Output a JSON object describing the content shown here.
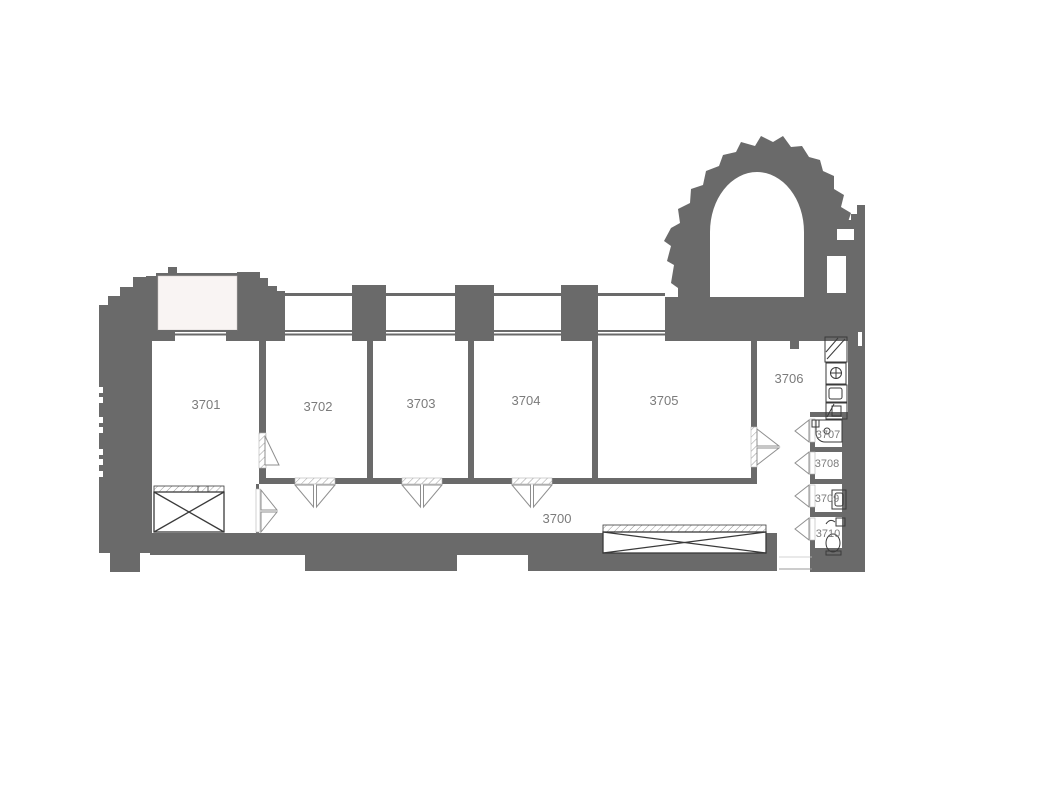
{
  "plan": {
    "type": "architectural-floor-plan",
    "colors": {
      "wall": "#6a6a6a",
      "balcony_fill": "#f9f4f3",
      "label_text": "#7b7b7b",
      "fixture_line": "#3a3a3a",
      "door_line": "#8f8f8f"
    },
    "rooms": [
      {
        "number": "3700",
        "kind": "corridor"
      },
      {
        "number": "3701",
        "kind": "room"
      },
      {
        "number": "3702",
        "kind": "room"
      },
      {
        "number": "3703",
        "kind": "room"
      },
      {
        "number": "3704",
        "kind": "room"
      },
      {
        "number": "3705",
        "kind": "room"
      },
      {
        "number": "3706",
        "kind": "kitchen-area"
      },
      {
        "number": "3707",
        "kind": "wc"
      },
      {
        "number": "3708",
        "kind": "wc"
      },
      {
        "number": "3709",
        "kind": "wc"
      },
      {
        "number": "3710",
        "kind": "wc"
      }
    ]
  }
}
